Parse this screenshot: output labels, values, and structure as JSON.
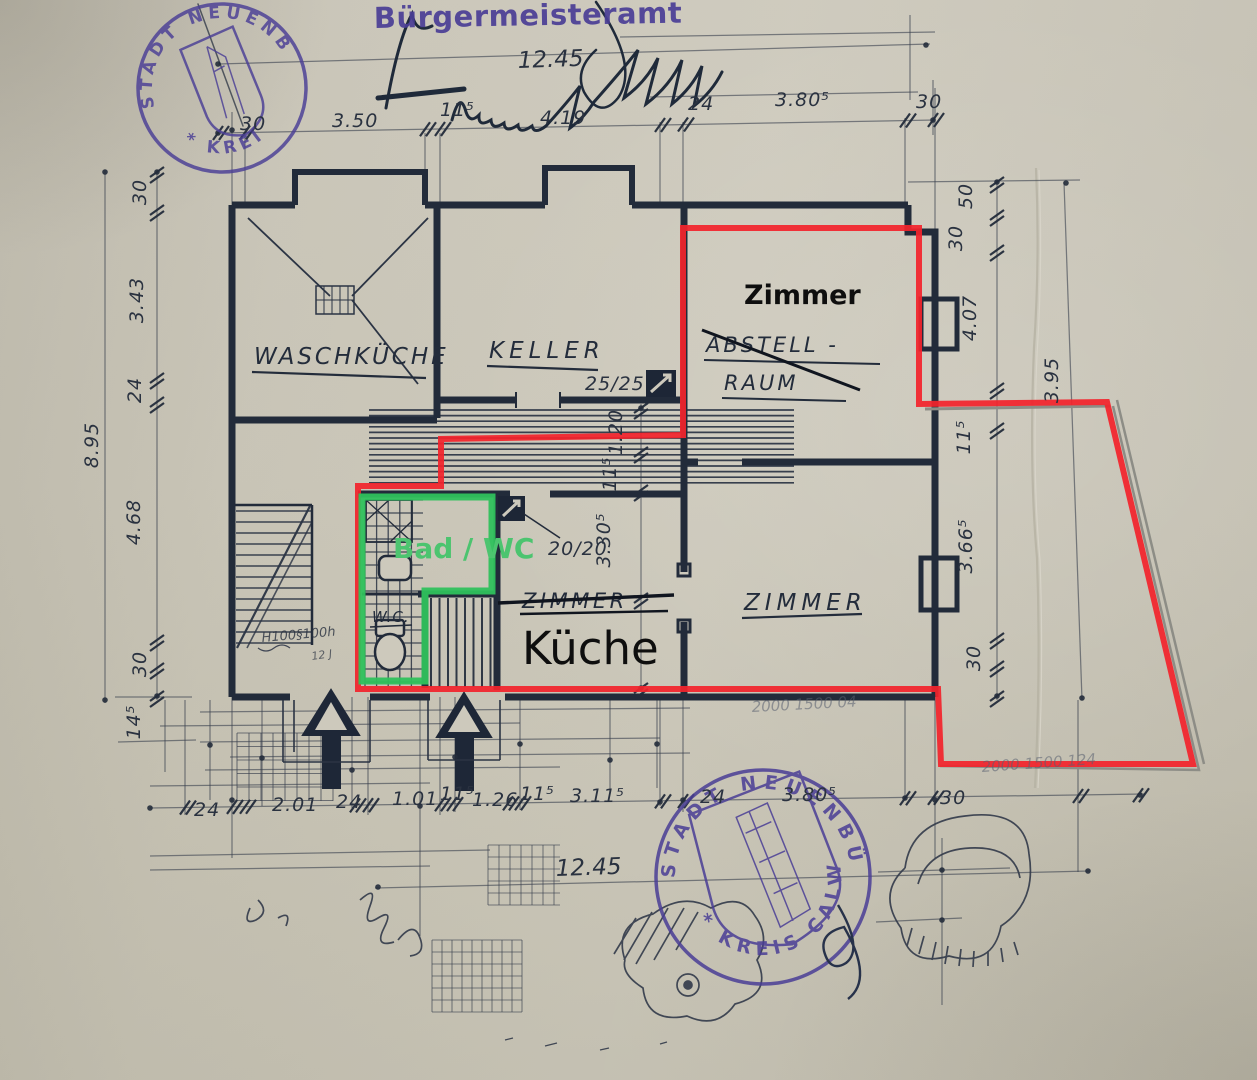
{
  "stamps": {
    "office": "Bürgermeisteramt",
    "top_round": {
      "upper": "STADT NEUENBÜRG",
      "lower": "* KREI"
    },
    "bottom_round": {
      "upper": "STADT NEUENBÜRG",
      "lower": "* KREIS CALW"
    }
  },
  "annotations": {
    "zimmer": "Zimmer",
    "kueche": "Küche",
    "bad_wc": "Bad / WC"
  },
  "rooms": {
    "waschkueche": "WASCHKÜCHE",
    "keller": "KELLER",
    "abstell1": "ABSTELL -",
    "abstell2": "RAUM",
    "zimmer_struck": "ZIMMER",
    "zimmer_right": "ZIMMER",
    "wc": "W.C."
  },
  "chimneys": {
    "c1": "25/25",
    "c2": "20/20"
  },
  "dims": {
    "top_total": "12.45",
    "top": [
      "30",
      "3.50",
      "11⁵",
      "4.19",
      "24",
      "3.80⁵",
      "30"
    ],
    "left_total": "8.95",
    "left": [
      "30",
      "3.43",
      "24",
      "4.68",
      "30"
    ],
    "left_below": "14⁵",
    "right": [
      "50",
      "30",
      "4.07",
      "11⁵",
      "3.66⁵",
      "30"
    ],
    "right_outer": "3.95",
    "hall": [
      "1.20",
      "11⁵",
      "3.30⁵"
    ],
    "bottom": [
      "24",
      "2.01",
      "24",
      "1.01",
      "11⁵",
      "1.26",
      "11⁵",
      "3.11⁵",
      "24",
      "3.80⁵",
      "30"
    ],
    "bottom_total": "12.45"
  },
  "handwriting": {
    "window_note": "H100§100h",
    "note2": "12 J",
    "scribble_a": "2000 1500 04",
    "scribble_b": "2000 1500 124"
  },
  "colors": {
    "ink": "#232c3b",
    "red_outline": "#f2242c",
    "green_outline": "#2fc15c",
    "stamp_purple": "#4a3e96"
  }
}
